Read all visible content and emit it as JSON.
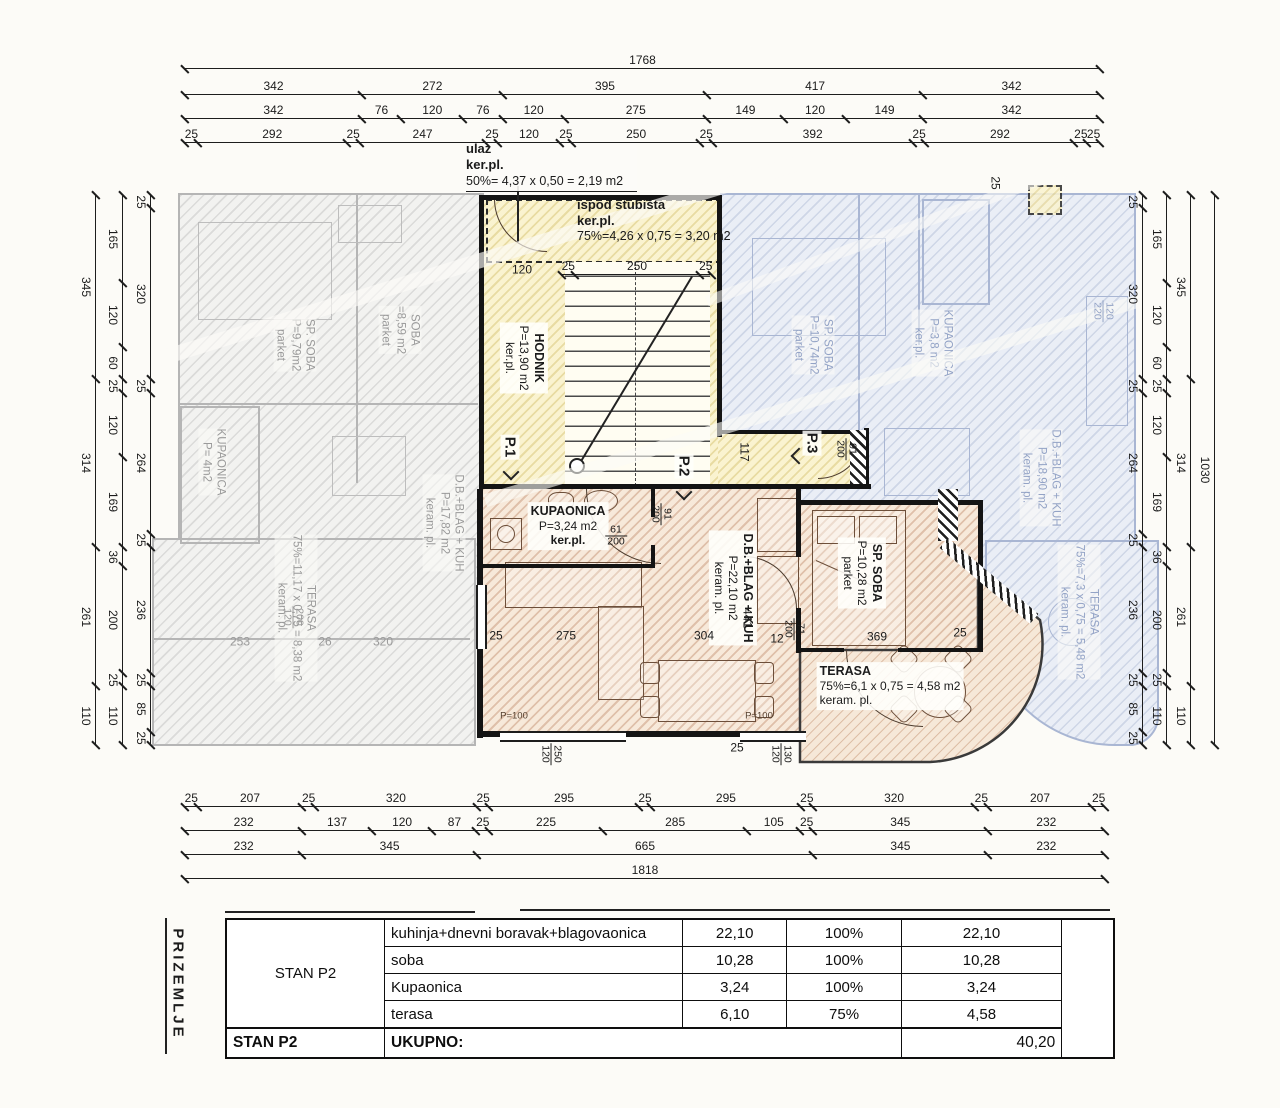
{
  "plan": {
    "entrance": {
      "title": "ulaz",
      "floor": "ker.pl.",
      "formula": "50%= 4,37 x 0,50 = 2,19 m2"
    },
    "under_stairs": {
      "title": "ispod stubišta",
      "floor": "ker.pl.",
      "formula": "75%=4,26 x 0,75 = 3,20 m2"
    },
    "hodnik": {
      "name": "HODNIK",
      "area": "P=13,90 m2",
      "floor": "ker.pl."
    },
    "entry_points": {
      "p1": "P.1",
      "p2": "P.2",
      "p3": "P.3"
    },
    "rooms": {
      "kupaonica": {
        "name": "KUPAONICA",
        "area": "P=3,24 m2",
        "floor": "ker.pl."
      },
      "living": {
        "name": "D.B.+BLAG + KUH",
        "area": "P=22,10 m2",
        "floor": "keram. pl."
      },
      "bedroom": {
        "name": "SP. SOBA",
        "area": "P=10,28 m2",
        "floor": "parket"
      },
      "terrace": {
        "name": "TERASA",
        "formula": "75%=6,1 x 0,75 = 4,58 m2",
        "floor": "keram. pl."
      }
    },
    "neighbors": {
      "left": [
        {
          "id": "nl-bedroom1",
          "lines": [
            "SP. SOBA",
            "P=9,79m2",
            "parket"
          ]
        },
        {
          "id": "nl-bedroom2",
          "lines": [
            "SOBA",
            "=8,59 m2",
            "parket"
          ]
        },
        {
          "id": "nl-bath",
          "lines": [
            "KUPAONICA",
            "P= 4m2"
          ]
        },
        {
          "id": "nl-living",
          "lines": [
            "D.B.+BLAG + KUH",
            "P=17,82 m2",
            "keram. pl."
          ]
        },
        {
          "id": "nl-terrace",
          "lines": [
            "TERASA",
            "75%=11,17 x 0,75 = 8,38 m2",
            "keram. pl."
          ]
        }
      ],
      "right": [
        {
          "id": "nr-bedroom",
          "lines": [
            "SP. SOBA",
            "P=10,74m2",
            "parket"
          ]
        },
        {
          "id": "nr-bath",
          "lines": [
            "KUPAONICA",
            "P=3,8 m2",
            "ker.pl."
          ]
        },
        {
          "id": "nr-living",
          "lines": [
            "D.B.+BLAG + KUH",
            "P=18,90 m2",
            "keram. pl."
          ]
        },
        {
          "id": "nr-terrace",
          "lines": [
            "TERASA",
            "75%=7,3 x 0,75 = 5,48 m2",
            "keram. pl."
          ]
        }
      ]
    }
  },
  "dims": {
    "top": [
      {
        "id": "t1",
        "values": [
          "1768"
        ]
      },
      {
        "id": "t2",
        "values": [
          "342",
          "272",
          "395",
          "417",
          "342"
        ]
      },
      {
        "id": "t3",
        "values": [
          "342",
          "76",
          "120",
          "76",
          "120",
          "275",
          "149",
          "120",
          "149",
          "342"
        ]
      },
      {
        "id": "t4",
        "values": [
          "25",
          "292",
          "25",
          "247",
          "25",
          "120",
          "25",
          "250",
          "25",
          "392",
          "25",
          "292",
          "25",
          "25"
        ]
      }
    ],
    "bottom": [
      {
        "id": "b1",
        "values": [
          "25",
          "207",
          "25",
          "320",
          "25",
          "295",
          "25",
          "295",
          "25",
          "320",
          "25",
          "207",
          "25"
        ]
      },
      {
        "id": "b2",
        "values": [
          "232",
          "137",
          "120",
          "87",
          "25",
          "225",
          "285",
          "105",
          "25",
          "345",
          "232"
        ]
      },
      {
        "id": "b3",
        "values": [
          "232",
          "345",
          "665",
          "345",
          "232"
        ]
      },
      {
        "id": "b4",
        "values": [
          "1818"
        ]
      }
    ],
    "left": [
      {
        "id": "l1",
        "values": [
          "345",
          "314",
          "261",
          "110"
        ]
      },
      {
        "id": "l2",
        "values": [
          "165",
          "120",
          "60",
          "25",
          "120",
          "169",
          "36",
          "200",
          "25",
          "110"
        ]
      },
      {
        "id": "l3",
        "values": [
          "25",
          "320",
          "25",
          "264",
          "25",
          "236",
          "25",
          "85",
          "25"
        ]
      }
    ],
    "right": [
      {
        "id": "r1",
        "values": [
          "25",
          "320",
          "25",
          "264",
          "25",
          "236",
          "25",
          "85",
          "25"
        ]
      },
      {
        "id": "r2",
        "values": [
          "165",
          "120",
          "60",
          "25",
          "120",
          "169",
          "36",
          "200",
          "25",
          "110"
        ]
      },
      {
        "id": "r3",
        "values": [
          "345",
          "314",
          "261",
          "110"
        ]
      },
      {
        "id": "r4",
        "values": [
          "1030"
        ]
      }
    ],
    "stairs": [
      {
        "id": "st",
        "values": [
          "25",
          "250",
          "25"
        ]
      }
    ]
  },
  "misc": [
    {
      "id": "dim-117",
      "text": "117"
    },
    {
      "id": "dim-441",
      "text": "441"
    },
    {
      "id": "dim-25-bath",
      "text": "25"
    },
    {
      "id": "dim-275",
      "text": "275"
    },
    {
      "id": "dim-304",
      "text": "304"
    },
    {
      "id": "dim-12",
      "text": "12"
    },
    {
      "id": "dim-369",
      "text": "369"
    },
    {
      "id": "dim-25-bed",
      "text": "25"
    },
    {
      "id": "dim-120-entry",
      "text": "120"
    },
    {
      "id": "dim-25-topright",
      "text": "25"
    },
    {
      "id": "win-p100-a",
      "text": "P=100"
    },
    {
      "id": "win-p100-b",
      "text": "P=100"
    },
    {
      "id": "dim-25-win",
      "text": "25"
    },
    {
      "id": "dim-26-left",
      "text": "26"
    },
    {
      "id": "dim-320-left",
      "text": "320"
    },
    {
      "id": "dim-253-left",
      "text": "253"
    }
  ],
  "fractions": [
    {
      "id": "fr-91-200-hall",
      "top": "91",
      "bottom": "200"
    },
    {
      "id": "fr-61-200-bath",
      "top": "61",
      "bottom": "200"
    },
    {
      "id": "fr-71-200-bed",
      "top": "71",
      "bottom": "200"
    },
    {
      "id": "fr-91-200-p3",
      "top": "91",
      "bottom": "200"
    },
    {
      "id": "fr-250-120",
      "top": "250",
      "bottom": "120"
    },
    {
      "id": "fr-130-120",
      "top": "130",
      "bottom": "120"
    },
    {
      "id": "fr-200-120-l",
      "top": "200",
      "bottom": "120"
    },
    {
      "id": "fr-120-220-r",
      "top": "120",
      "bottom": "220"
    }
  ],
  "table": {
    "side_label": "PRIZEMLJE",
    "group": "STAN P2",
    "rows": [
      {
        "name": "kuhinja+dnevni boravak+blagovaonica",
        "value": "22,10",
        "pct": "100%",
        "result": "22,10"
      },
      {
        "name": "soba",
        "value": "10,28",
        "pct": "100%",
        "result": "10,28"
      },
      {
        "name": "Kupaonica",
        "value": "3,24",
        "pct": "100%",
        "result": "3,24"
      },
      {
        "name": "terasa",
        "value": "6,10",
        "pct": "75%",
        "result": "4,58"
      }
    ],
    "footer": {
      "group": "STAN P2",
      "label": "UKUPNO:",
      "total": "40,20"
    }
  }
}
